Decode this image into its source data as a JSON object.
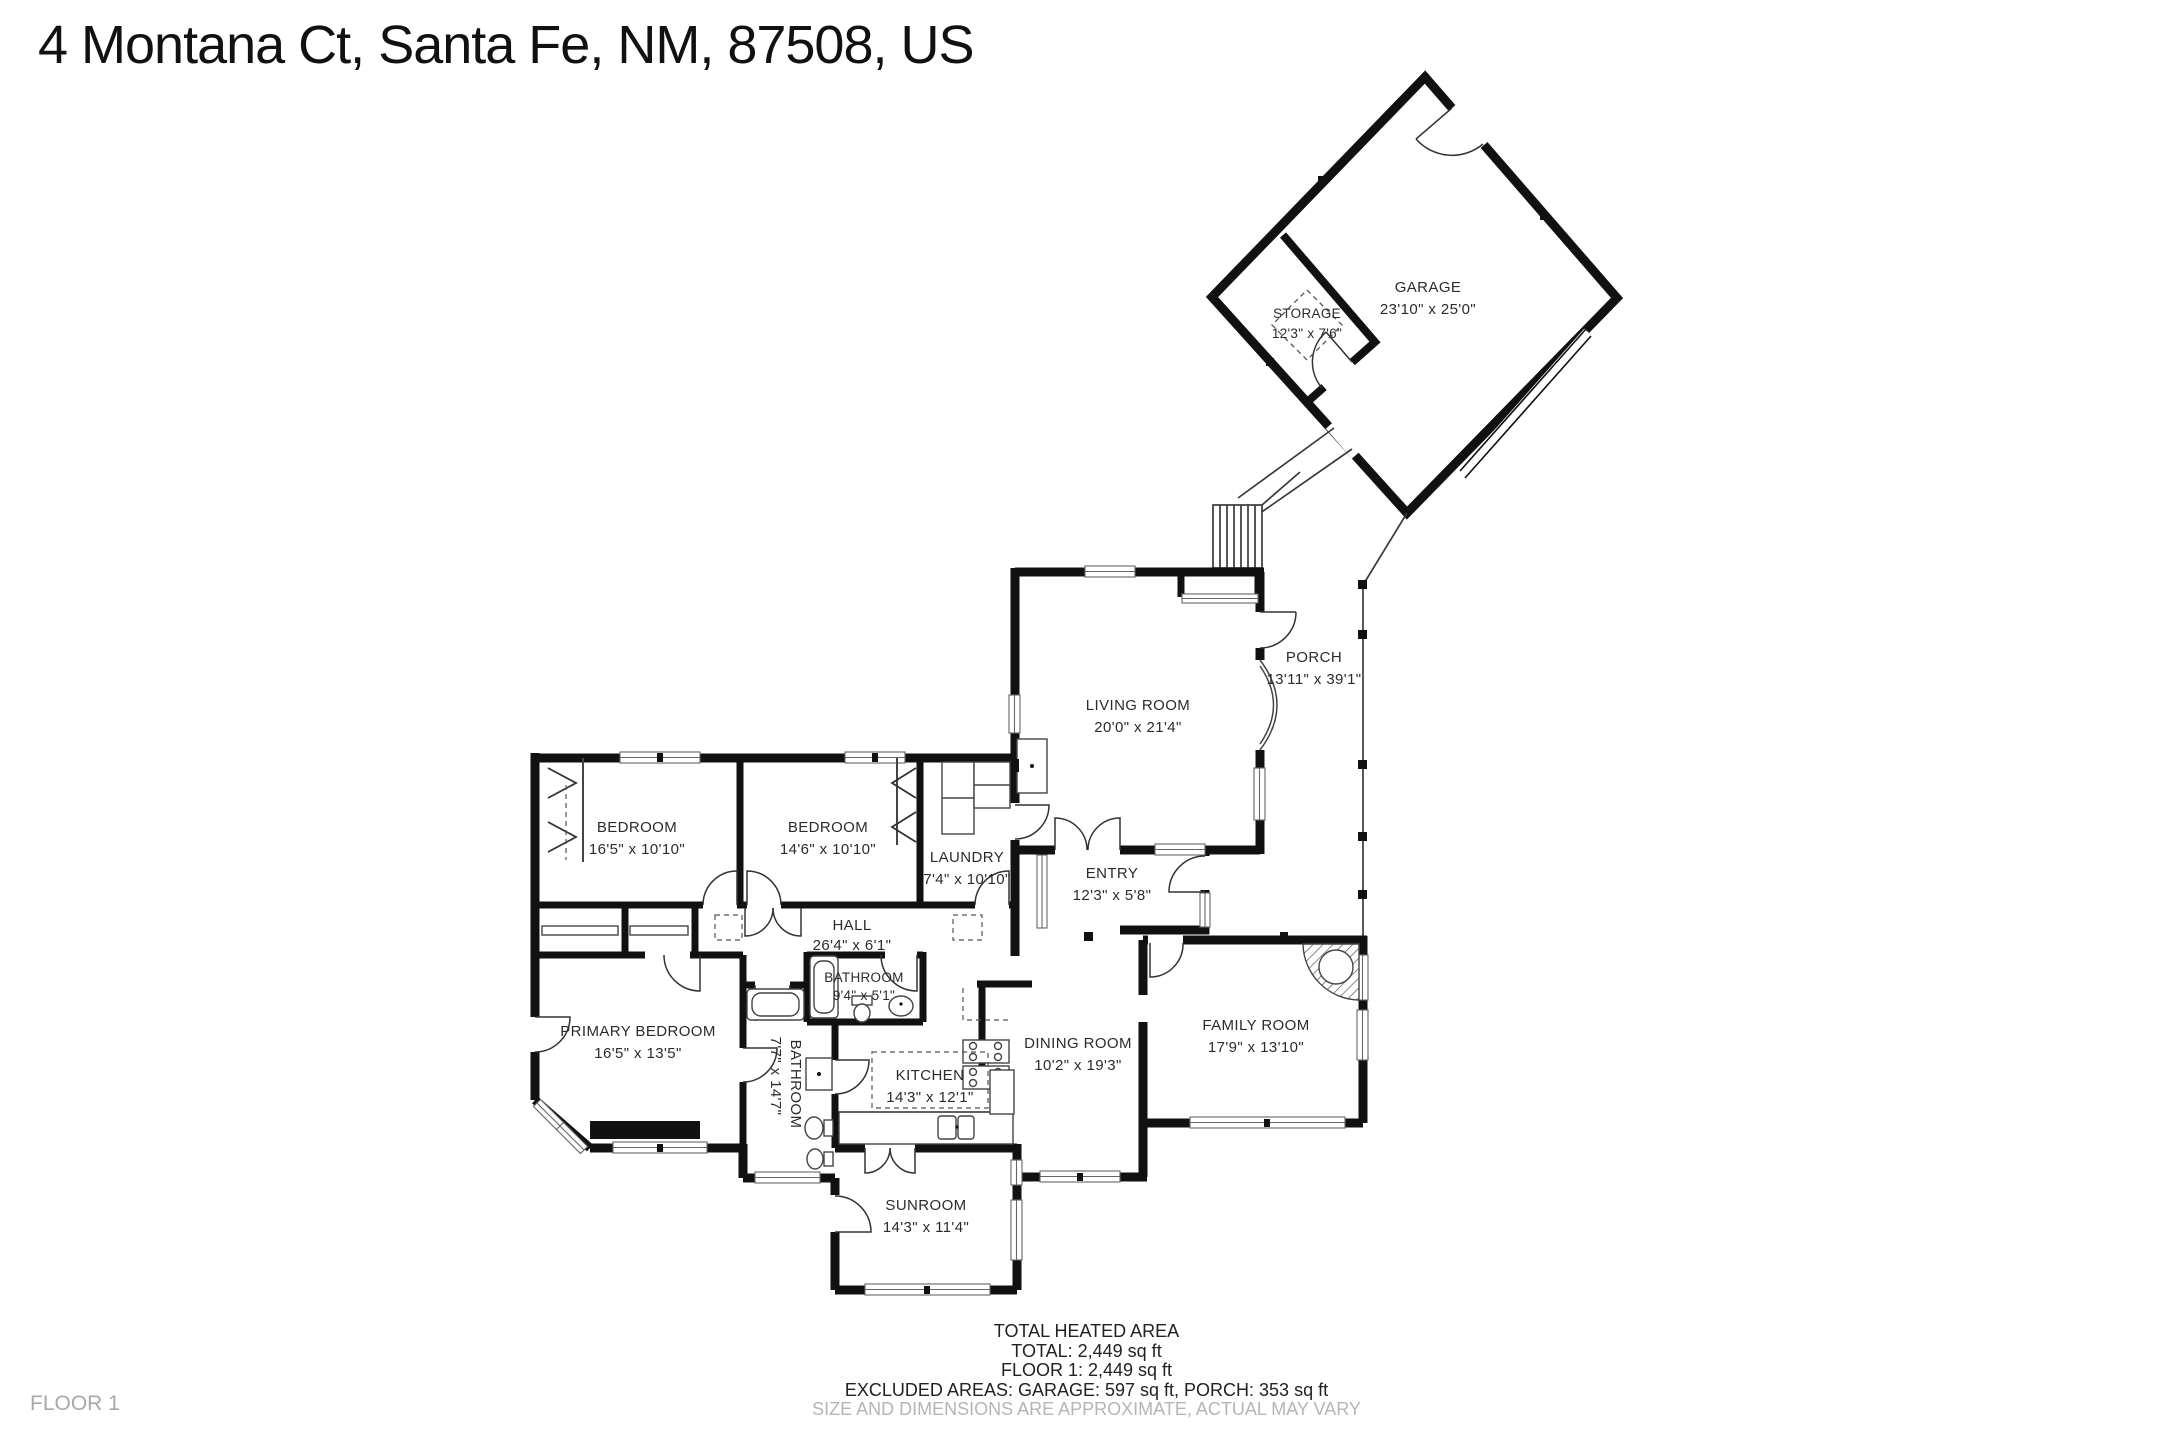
{
  "title": "4 Montana Ct, Santa Fe, NM, 87508, US",
  "floor_label": "FLOOR 1",
  "summary": {
    "heading": "TOTAL HEATED AREA",
    "total": "TOTAL: 2,449 sq ft",
    "floor1": "FLOOR 1: 2,449 sq ft",
    "excluded": "EXCLUDED AREAS: GARAGE: 597 sq ft, PORCH: 353 sq ft",
    "disclaimer": "SIZE AND DIMENSIONS ARE APPROXIMATE, ACTUAL MAY VARY"
  },
  "rooms": {
    "garage": {
      "name": "GARAGE",
      "dims": "23'10\" x 25'0\""
    },
    "storage": {
      "name": "STORAGE",
      "dims": "12'3\" x 7'6\""
    },
    "porch": {
      "name": "PORCH",
      "dims": "13'11\" x 39'1\""
    },
    "living_room": {
      "name": "LIVING ROOM",
      "dims": "20'0\" x 21'4\""
    },
    "bedroom_left": {
      "name": "BEDROOM",
      "dims": "16'5\" x 10'10\""
    },
    "bedroom_right": {
      "name": "BEDROOM",
      "dims": "14'6\" x 10'10\""
    },
    "laundry": {
      "name": "LAUNDRY",
      "dims": "7'4\" x 10'10\""
    },
    "hall": {
      "name": "HALL",
      "dims": "26'4\" x 6'1\""
    },
    "entry": {
      "name": "ENTRY",
      "dims": "12'3\" x 5'8\""
    },
    "bathroom_small": {
      "name": "BATHROOM",
      "dims": "9'4\" x 5'1\""
    },
    "bathroom_large": {
      "name": "BATHROOM",
      "dims": "7'7\" x 14'7\""
    },
    "primary_bedroom": {
      "name": "PRIMARY BEDROOM",
      "dims": "16'5\" x 13'5\""
    },
    "kitchen": {
      "name": "KITCHEN",
      "dims": "14'3\" x 12'1\""
    },
    "dining_room": {
      "name": "DINING ROOM",
      "dims": "10'2\" x 19'3\""
    },
    "family_room": {
      "name": "FAMILY ROOM",
      "dims": "17'9\" x 13'10\""
    },
    "sunroom": {
      "name": "SUNROOM",
      "dims": "14'3\" x 11'4\""
    }
  },
  "colors": {
    "wall": "#111111",
    "label": "#2b2b2b",
    "muted": "#b5b5b5",
    "thin": "#3a3a3a"
  }
}
